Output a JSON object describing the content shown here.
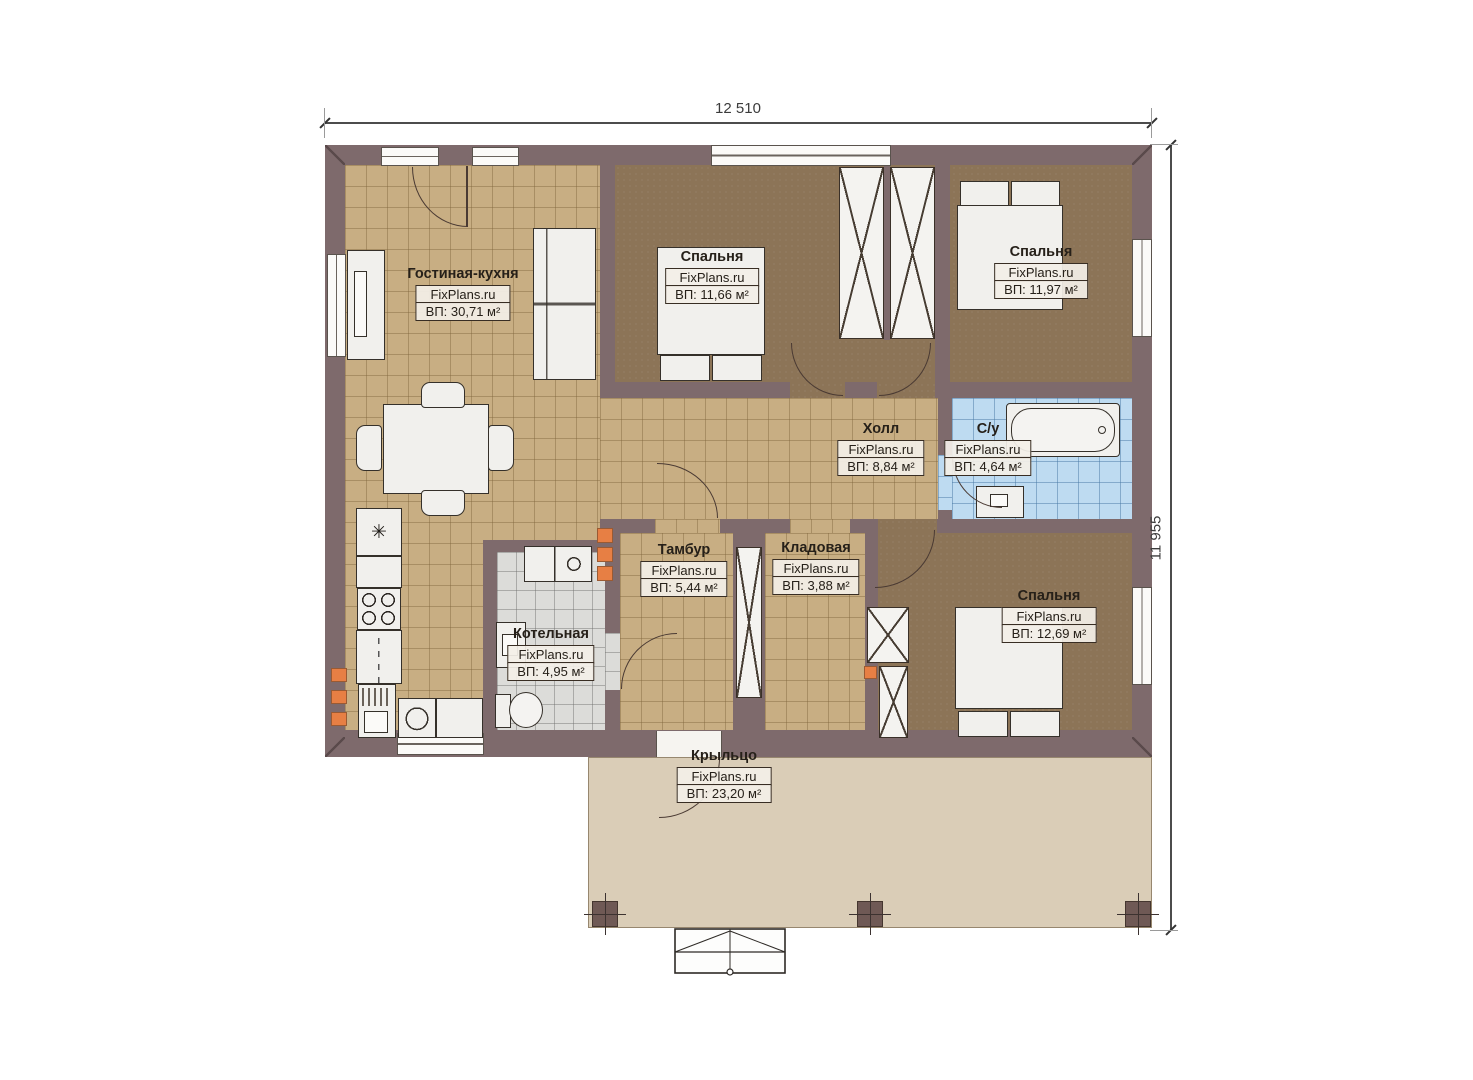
{
  "plan": {
    "dim_width": "12 510",
    "dim_height": "11 955",
    "brand": "FixPlans.ru",
    "colors": {
      "wall": "#7e6a6c",
      "tile_tan": "#c8ae83",
      "floor_brown": "#8c7457",
      "tile_blue": "#bedbf1",
      "tile_gray": "#dcdcd9",
      "porch": "#dacdb7",
      "marker_orange": "#e77f44"
    },
    "rooms": [
      {
        "id": "living-kitchen",
        "name": "Гостиная-кухня",
        "brand": "FixPlans.ru",
        "area": "ВП: 30,71 м²"
      },
      {
        "id": "bedroom-1",
        "name": "Спальня",
        "brand": "FixPlans.ru",
        "area": "ВП: 11,66 м²"
      },
      {
        "id": "bedroom-2",
        "name": "Спальня",
        "brand": "FixPlans.ru",
        "area": "ВП: 11,97 м²"
      },
      {
        "id": "hall",
        "name": "Холл",
        "brand": "FixPlans.ru",
        "area": "ВП: 8,84 м²"
      },
      {
        "id": "bathroom",
        "name": "С/у",
        "brand": "FixPlans.ru",
        "area": "ВП: 4,64 м²"
      },
      {
        "id": "vestibule",
        "name": "Тамбур",
        "brand": "FixPlans.ru",
        "area": "ВП: 5,44 м²"
      },
      {
        "id": "storage",
        "name": "Кладовая",
        "brand": "FixPlans.ru",
        "area": "ВП: 3,88 м²"
      },
      {
        "id": "boiler-room",
        "name": "Котельная",
        "brand": "FixPlans.ru",
        "area": "ВП: 4,95 м²"
      },
      {
        "id": "bedroom-3",
        "name": "Спальня",
        "brand": "FixPlans.ru",
        "area": "ВП: 12,69 м²"
      },
      {
        "id": "porch",
        "name": "Крыльцо",
        "brand": "FixPlans.ru",
        "area": "ВП: 23,20 м²"
      }
    ]
  }
}
